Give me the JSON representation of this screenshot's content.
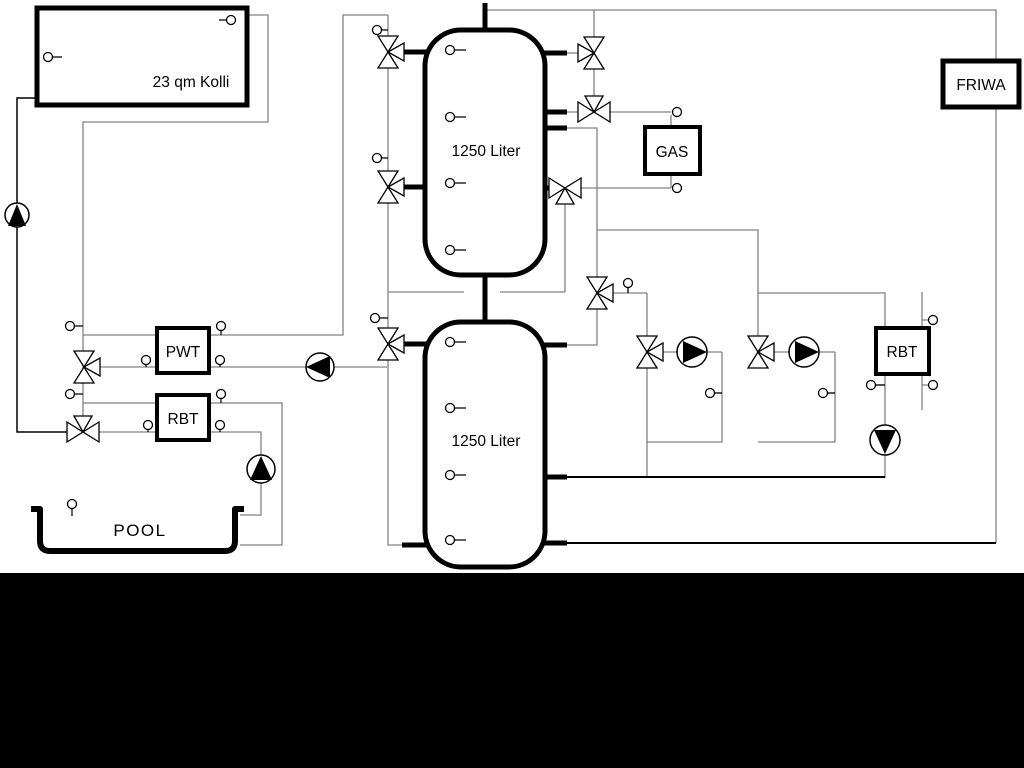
{
  "diagram": {
    "collector": {
      "label": "23 qm Kolli"
    },
    "buffer_tank_top": {
      "label": "1250 Liter"
    },
    "buffer_tank_bottom": {
      "label": "1250 Liter"
    },
    "gas_boiler": {
      "label": "GAS"
    },
    "friwa_station": {
      "label": "FRIWA"
    },
    "heat_exchanger_pwt": {
      "label": "PWT"
    },
    "heat_exchanger_rbt_pool": {
      "label": "RBT"
    },
    "heat_exchanger_rbt_right": {
      "label": "RBT"
    },
    "pool": {
      "label": "POOL"
    }
  },
  "colors": {
    "pipe_gray": "#828282",
    "line_black": "#000000",
    "background": "#ffffff",
    "bottom_band": "#000000"
  }
}
